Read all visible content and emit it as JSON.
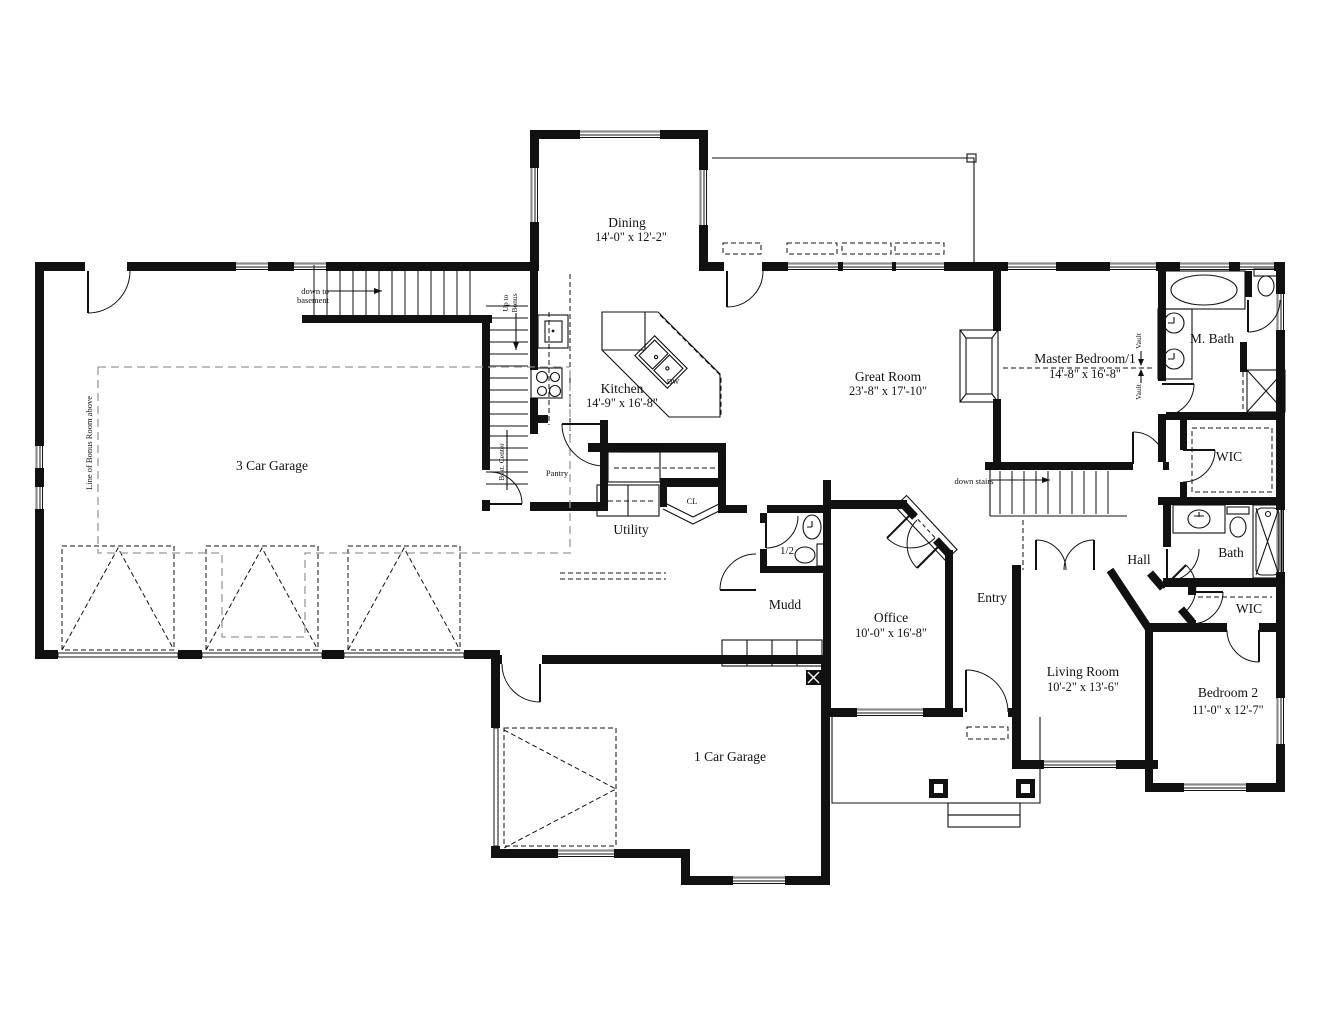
{
  "rooms": {
    "dining": {
      "name": "Dining",
      "dims": "14'-0\" x 12'-2\""
    },
    "kitchen": {
      "name": "Kitchen",
      "dims": "14'-9\" x 16'-8\""
    },
    "great_room": {
      "name": "Great Room",
      "dims": "23'-8\" x 17'-10\""
    },
    "master_bedroom": {
      "name": "Master Bedroom/1",
      "dims": "14'-8\" x 16'-8\""
    },
    "master_bath": {
      "name": "M. Bath"
    },
    "master_wic": {
      "name": "WIC"
    },
    "bath": {
      "name": "Bath"
    },
    "wic2": {
      "name": "WIC"
    },
    "bedroom2": {
      "name": "Bedroom 2",
      "dims": "11'-0\" x 12'-7\""
    },
    "living_room": {
      "name": "Living Room",
      "dims": "10'-2\" x 13'-6\""
    },
    "hall": {
      "name": "Hall"
    },
    "entry": {
      "name": "Entry"
    },
    "office": {
      "name": "Office",
      "dims": "10'-0\" x 16'-8\""
    },
    "mudd": {
      "name": "Mudd"
    },
    "half_bath": {
      "name": "1/2"
    },
    "utility": {
      "name": "Utility"
    },
    "pantry": {
      "name": "Pantry"
    },
    "closet": {
      "name": "CL"
    },
    "garage3": {
      "name": "3 Car Garage"
    },
    "garage1": {
      "name": "1 Car Garage"
    }
  },
  "annotations": {
    "down_to_basement_1": "down to",
    "down_to_basement_2": "basement",
    "up_to_bonus_1": "Up to",
    "up_to_bonus_2": "Bonus",
    "bskt_center": "Bskt. Center",
    "bonus_line": "Line of Bonus Room above",
    "down_stairs": "down stairs",
    "vault_upper": "Vault",
    "vault_lower": "Vault",
    "dishwasher": "DW"
  },
  "colors": {
    "wall": "#111111",
    "background": "#ffffff",
    "window_sill": "#8c8c8c",
    "bonus_dash": "#999999"
  }
}
